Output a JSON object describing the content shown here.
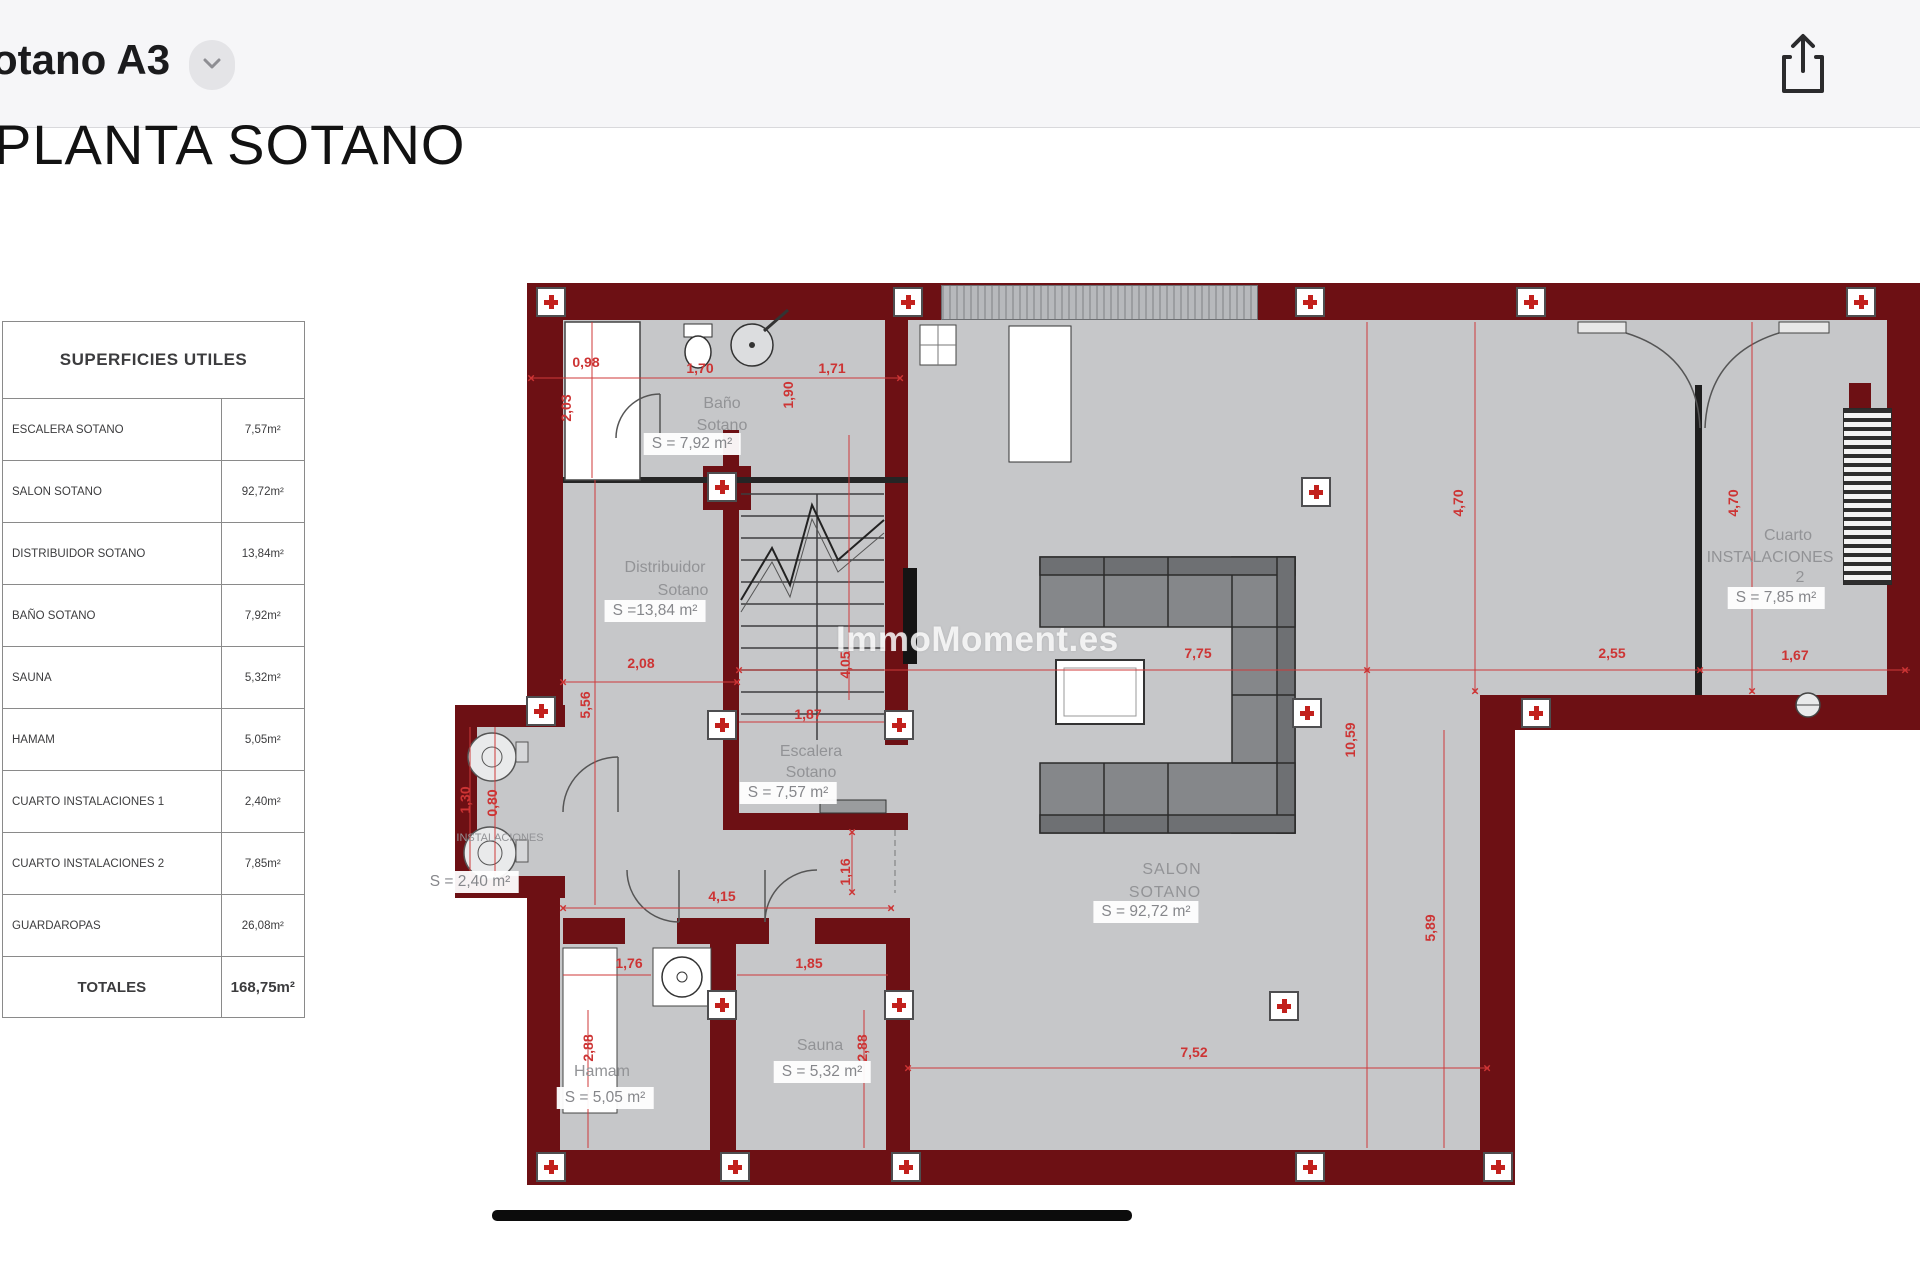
{
  "header": {
    "file_title": "otano A3"
  },
  "doc": {
    "title": "PLANTA SOTANO"
  },
  "table": {
    "header": "SUPERFICIES UTILES",
    "rows": [
      {
        "label": "ESCALERA SOTANO",
        "value": "7,57m²"
      },
      {
        "label": "SALON SOTANO",
        "value": "92,72m²"
      },
      {
        "label": "DISTRIBUIDOR SOTANO",
        "value": "13,84m²"
      },
      {
        "label": "BAÑO SOTANO",
        "value": "7,92m²"
      },
      {
        "label": "SAUNA",
        "value": "5,32m²"
      },
      {
        "label": "HAMAM",
        "value": "5,05m²"
      },
      {
        "label": "CUARTO INSTALACIONES 1",
        "value": "2,40m²"
      },
      {
        "label": "CUARTO INSTALACIONES 2",
        "value": "7,85m²"
      },
      {
        "label": "GUARDAROPAS",
        "value": "26,08m²"
      }
    ],
    "total": {
      "label": "TOTALES",
      "value": "168,75m²"
    }
  },
  "plan": {
    "rooms": {
      "bano": {
        "l1": "Baño",
        "l2": "Sotano",
        "area": "S = 7,92 m²"
      },
      "distribuidor": {
        "l1": "Distribuidor",
        "l2": "Sotano",
        "area": "S =13,84 m²"
      },
      "escalera": {
        "l1": "Escalera",
        "l2": "Sotano",
        "area": "S = 7,57 m²"
      },
      "salon": {
        "l1": "SALON",
        "l2": "SOTANO",
        "area": "S = 92,72 m²"
      },
      "sauna": {
        "l1": "Sauna",
        "area": "S = 5,32 m²"
      },
      "hamam": {
        "l1": "Hamam",
        "area": "S = 5,05 m²"
      },
      "instalaciones1": {
        "l1": "INSTALACIONES",
        "area": "S = 2,40 m²"
      },
      "cuarto2": {
        "l1": "Cuarto",
        "l2": "INSTALACIONES",
        "l3": "2",
        "area": "S = 7,85 m²"
      }
    },
    "dims": [
      "0,98",
      "2,03",
      "1,70",
      "1,90",
      "1,71",
      "2,08",
      "5,56",
      "4,05",
      "1,87",
      "4,15",
      "1,16",
      "1,76",
      "1,85",
      "2,88",
      "2,88",
      "7,75",
      "2,55",
      "1,67",
      "4,70",
      "4,70",
      "10,59",
      "5,89",
      "7,52",
      "1,30",
      "0,80"
    ]
  },
  "icons": {
    "dim_tick": "×"
  },
  "watermark": {
    "text": "ImmoMoment.es"
  }
}
